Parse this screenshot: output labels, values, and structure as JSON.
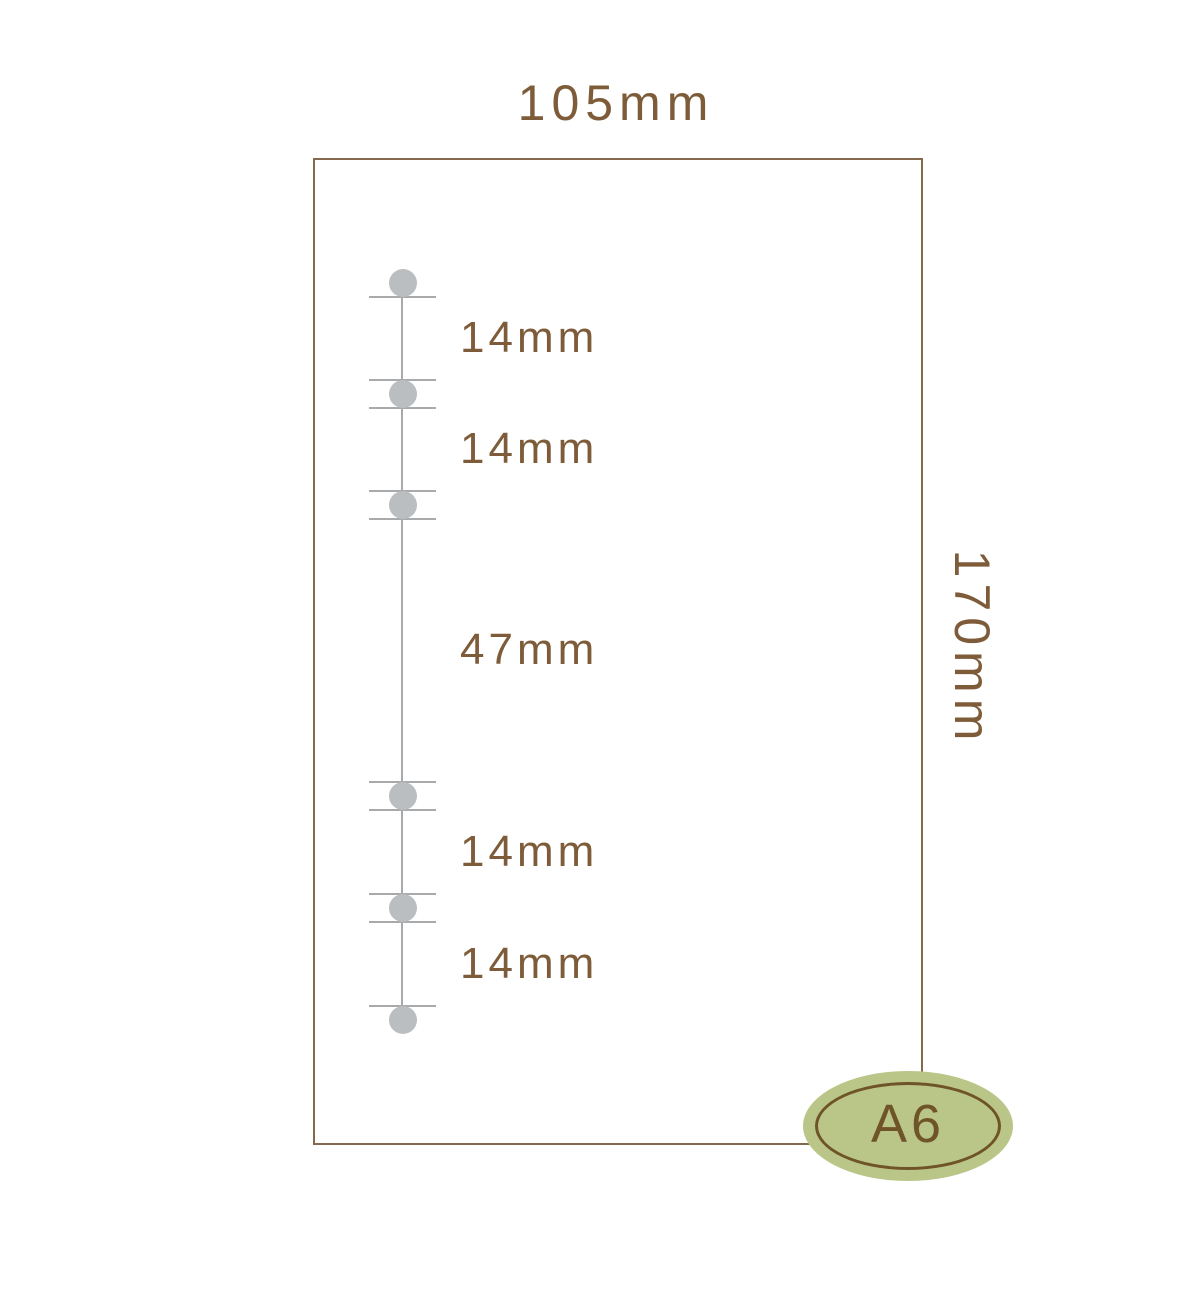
{
  "labels": {
    "width": "105mm",
    "height": "170mm",
    "badge": "A6"
  },
  "measurements": [
    {
      "label": "14mm"
    },
    {
      "label": "14mm"
    },
    {
      "label": "47mm"
    },
    {
      "label": "14mm"
    },
    {
      "label": "14mm"
    }
  ],
  "holes_count": 6,
  "colors": {
    "text_brown": "#7e5c3a",
    "outline_brown": "#84694c",
    "hole_gray": "#bbbec0",
    "line_gray": "#a8aaac",
    "badge_green": "#b9c687",
    "badge_brown": "#6f5329"
  }
}
